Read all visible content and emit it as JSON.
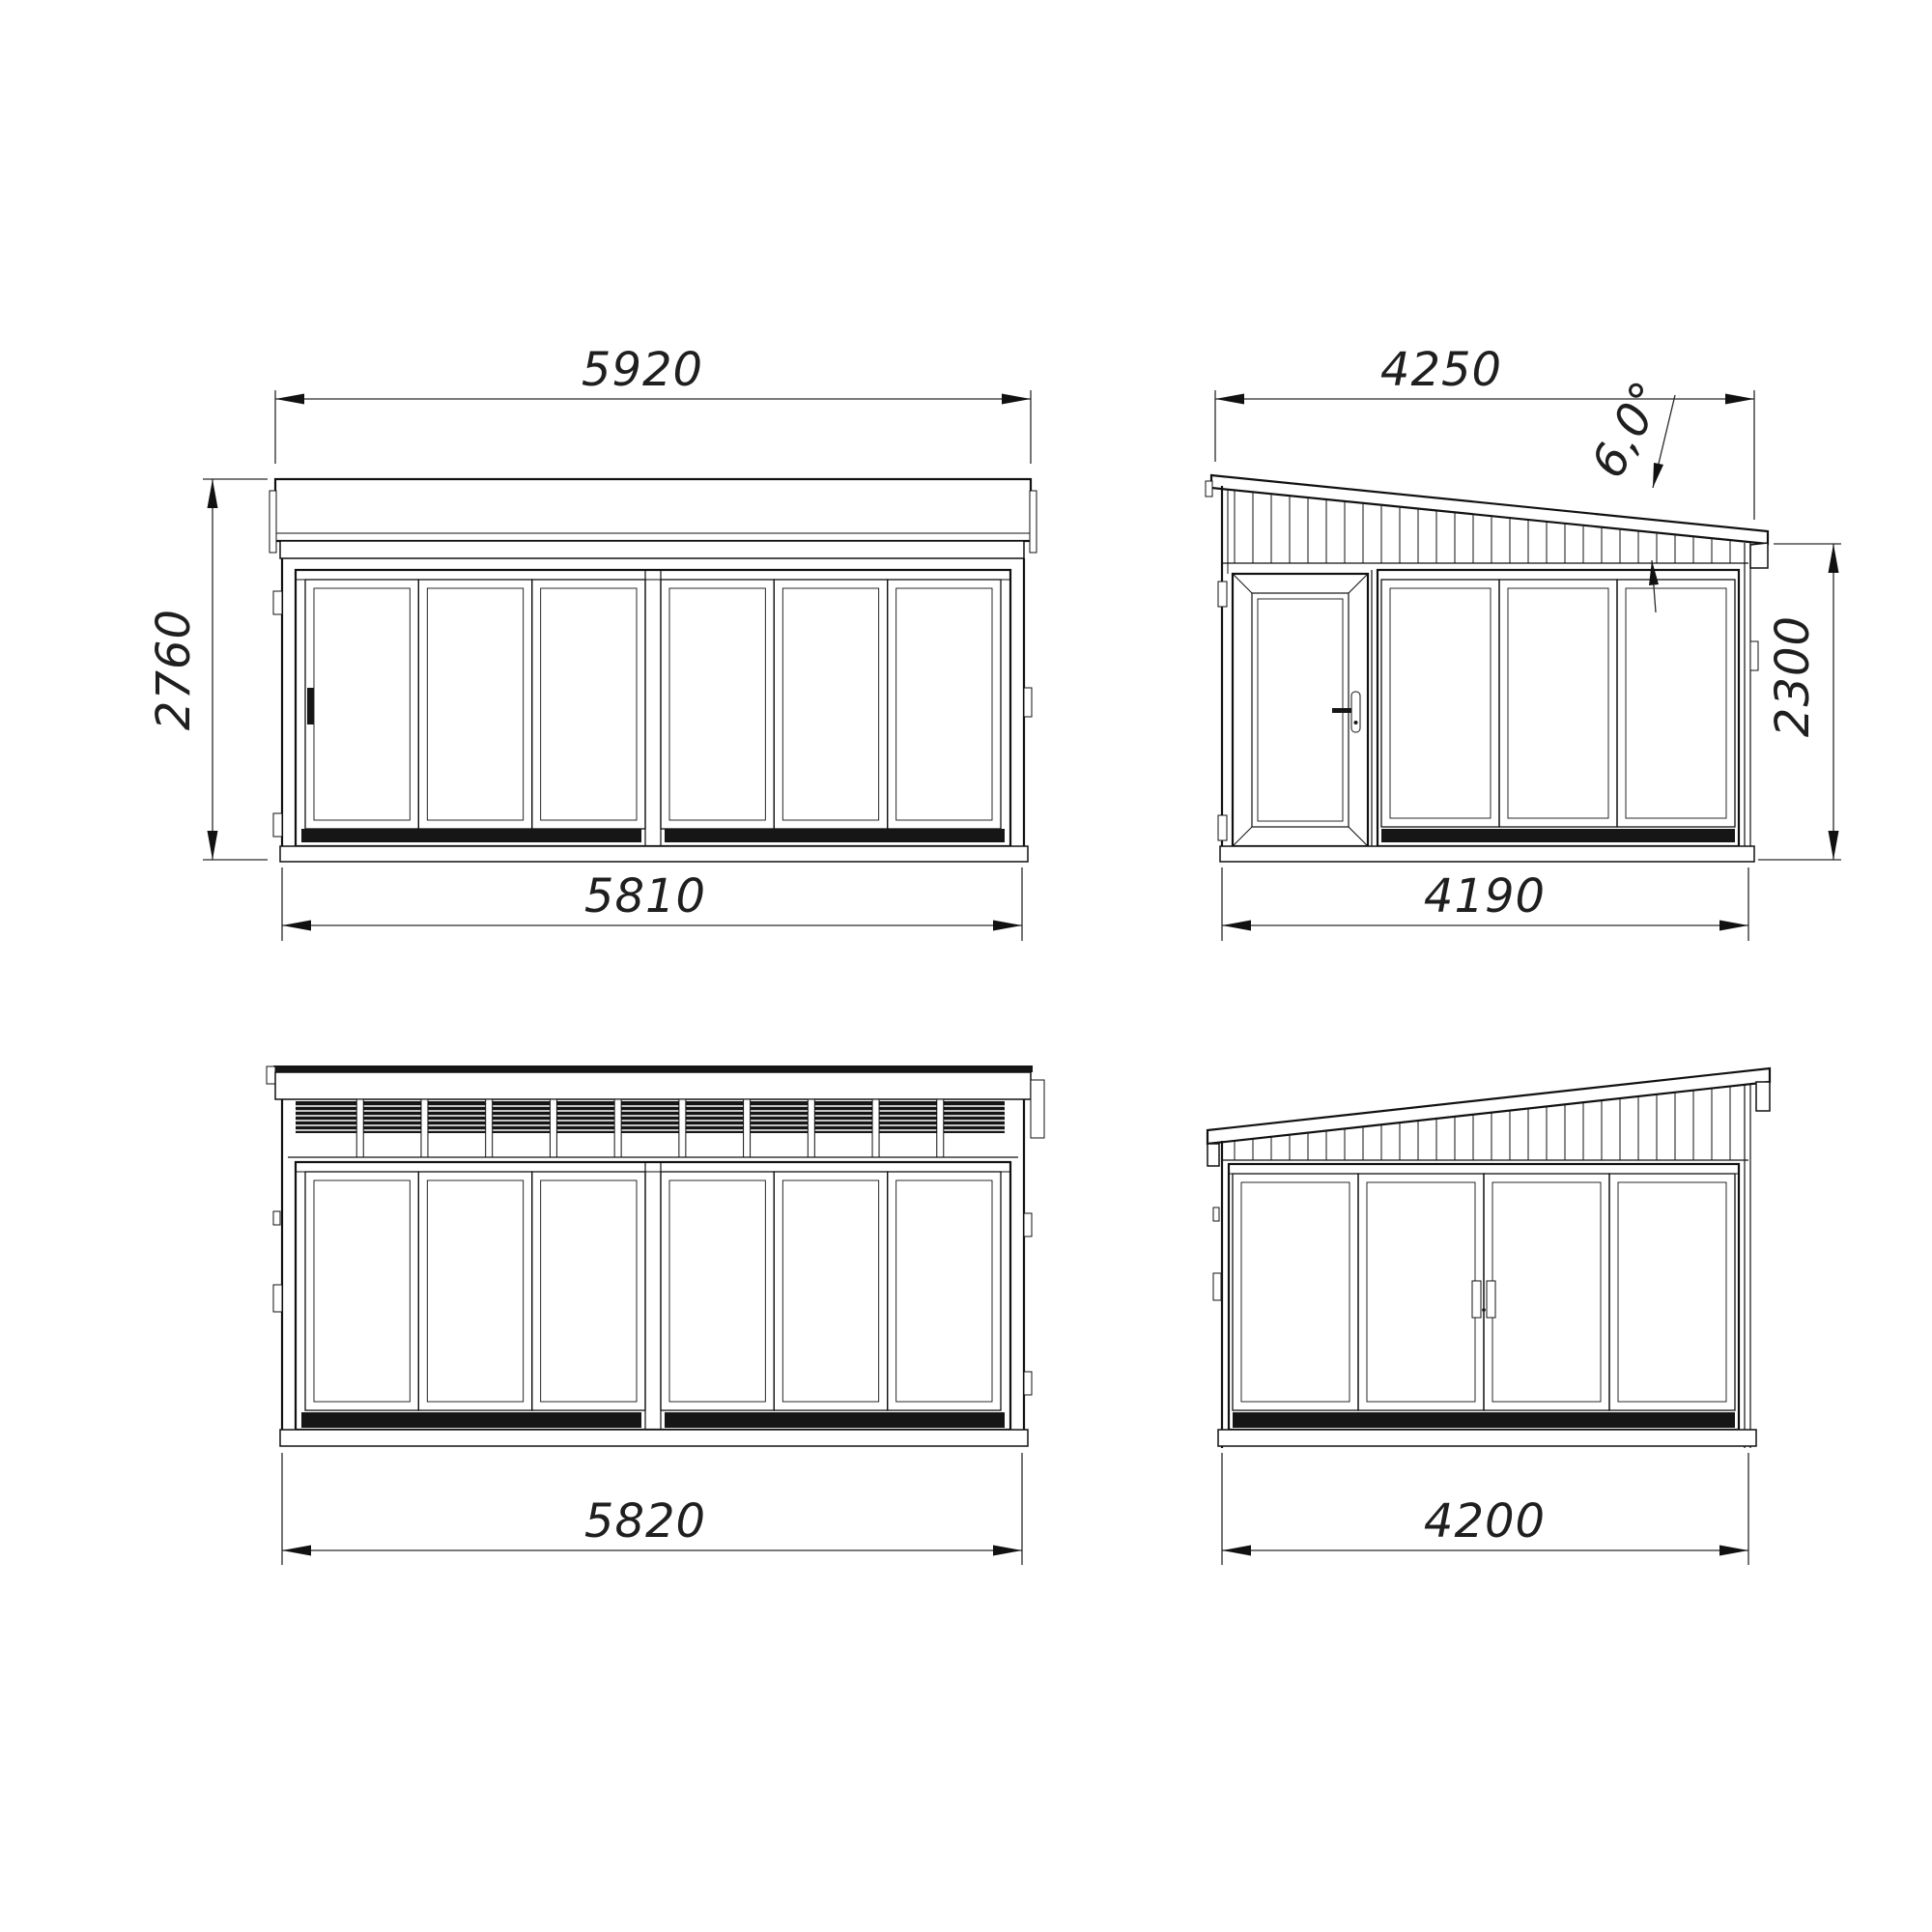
{
  "drawing": {
    "background": "#ffffff",
    "line_color": "#111111",
    "dim_color": "#1f1f1f",
    "dark_fill": "#161616",
    "views": {
      "front": {
        "top_width": "5920",
        "left_height": "2760",
        "bottom_width": "5810"
      },
      "side_door": {
        "top_width": "4250",
        "roof_angle": "6,0°",
        "right_height": "2300",
        "bottom_width": "4190"
      },
      "rear": {
        "bottom_width": "5820"
      },
      "side_sliding": {
        "bottom_width": "4200"
      }
    }
  }
}
